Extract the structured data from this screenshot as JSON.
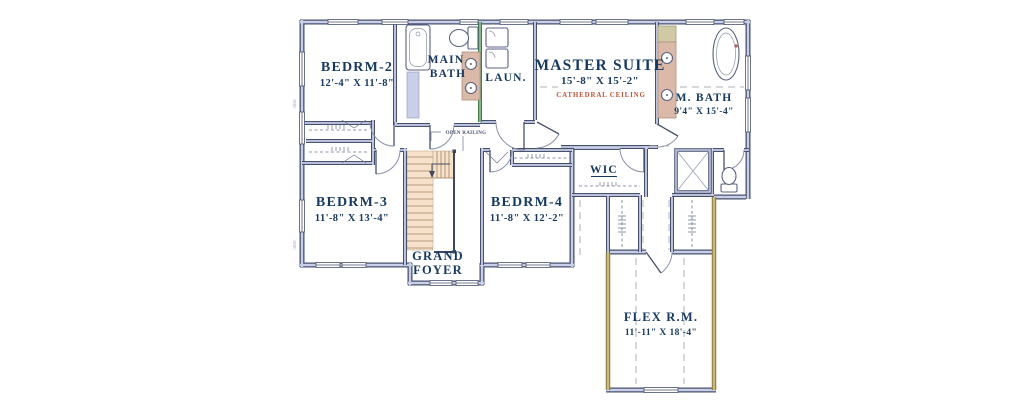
{
  "meta": {
    "type": "second-floor-plan"
  },
  "colors": {
    "wall": "#47506e",
    "wall_fill": "#c9cfe8",
    "laundry_wall_green": "#3f7d46",
    "attic_wall_tan": "#8a7840",
    "stair_fill": "#f6e2ca",
    "vanity_fill": "#dbb9a8",
    "label_navy": "#16395f",
    "cathedral_orange": "#c2553a",
    "background": "#ffffff"
  },
  "rooms": {
    "bedrm2": {
      "name": "BEDRM-2",
      "dims": "12'-4\" X 11'-8\""
    },
    "bedrm3": {
      "name": "BEDRM-3",
      "dims": "11'-8\" X 13'-4\""
    },
    "bedrm4": {
      "name": "BEDRM-4",
      "dims": "11'-8\" X 12'-2\""
    },
    "master_suite": {
      "name": "MASTER SUITE",
      "dims": "15'-8\" X 15'-2\"",
      "ceiling": "CATHEDRAL CEILING"
    },
    "master_bath": {
      "name": "M. BATH",
      "dims": "9'4\" X 15'-4\""
    },
    "main_bath": {
      "line1": "MAIN",
      "line2": "BATH"
    },
    "laundry": {
      "name": "LAUN."
    },
    "wic": {
      "name": "WIC"
    },
    "grand_foyer": {
      "line1": "GRAND",
      "line2": "FOYER"
    },
    "flex_room": {
      "name": "FLEX R.M.",
      "dims": "11'-11\" X 18'-4\""
    }
  },
  "annotations": {
    "open_railing": "OPEN RAILING",
    "window_label": "3050"
  }
}
